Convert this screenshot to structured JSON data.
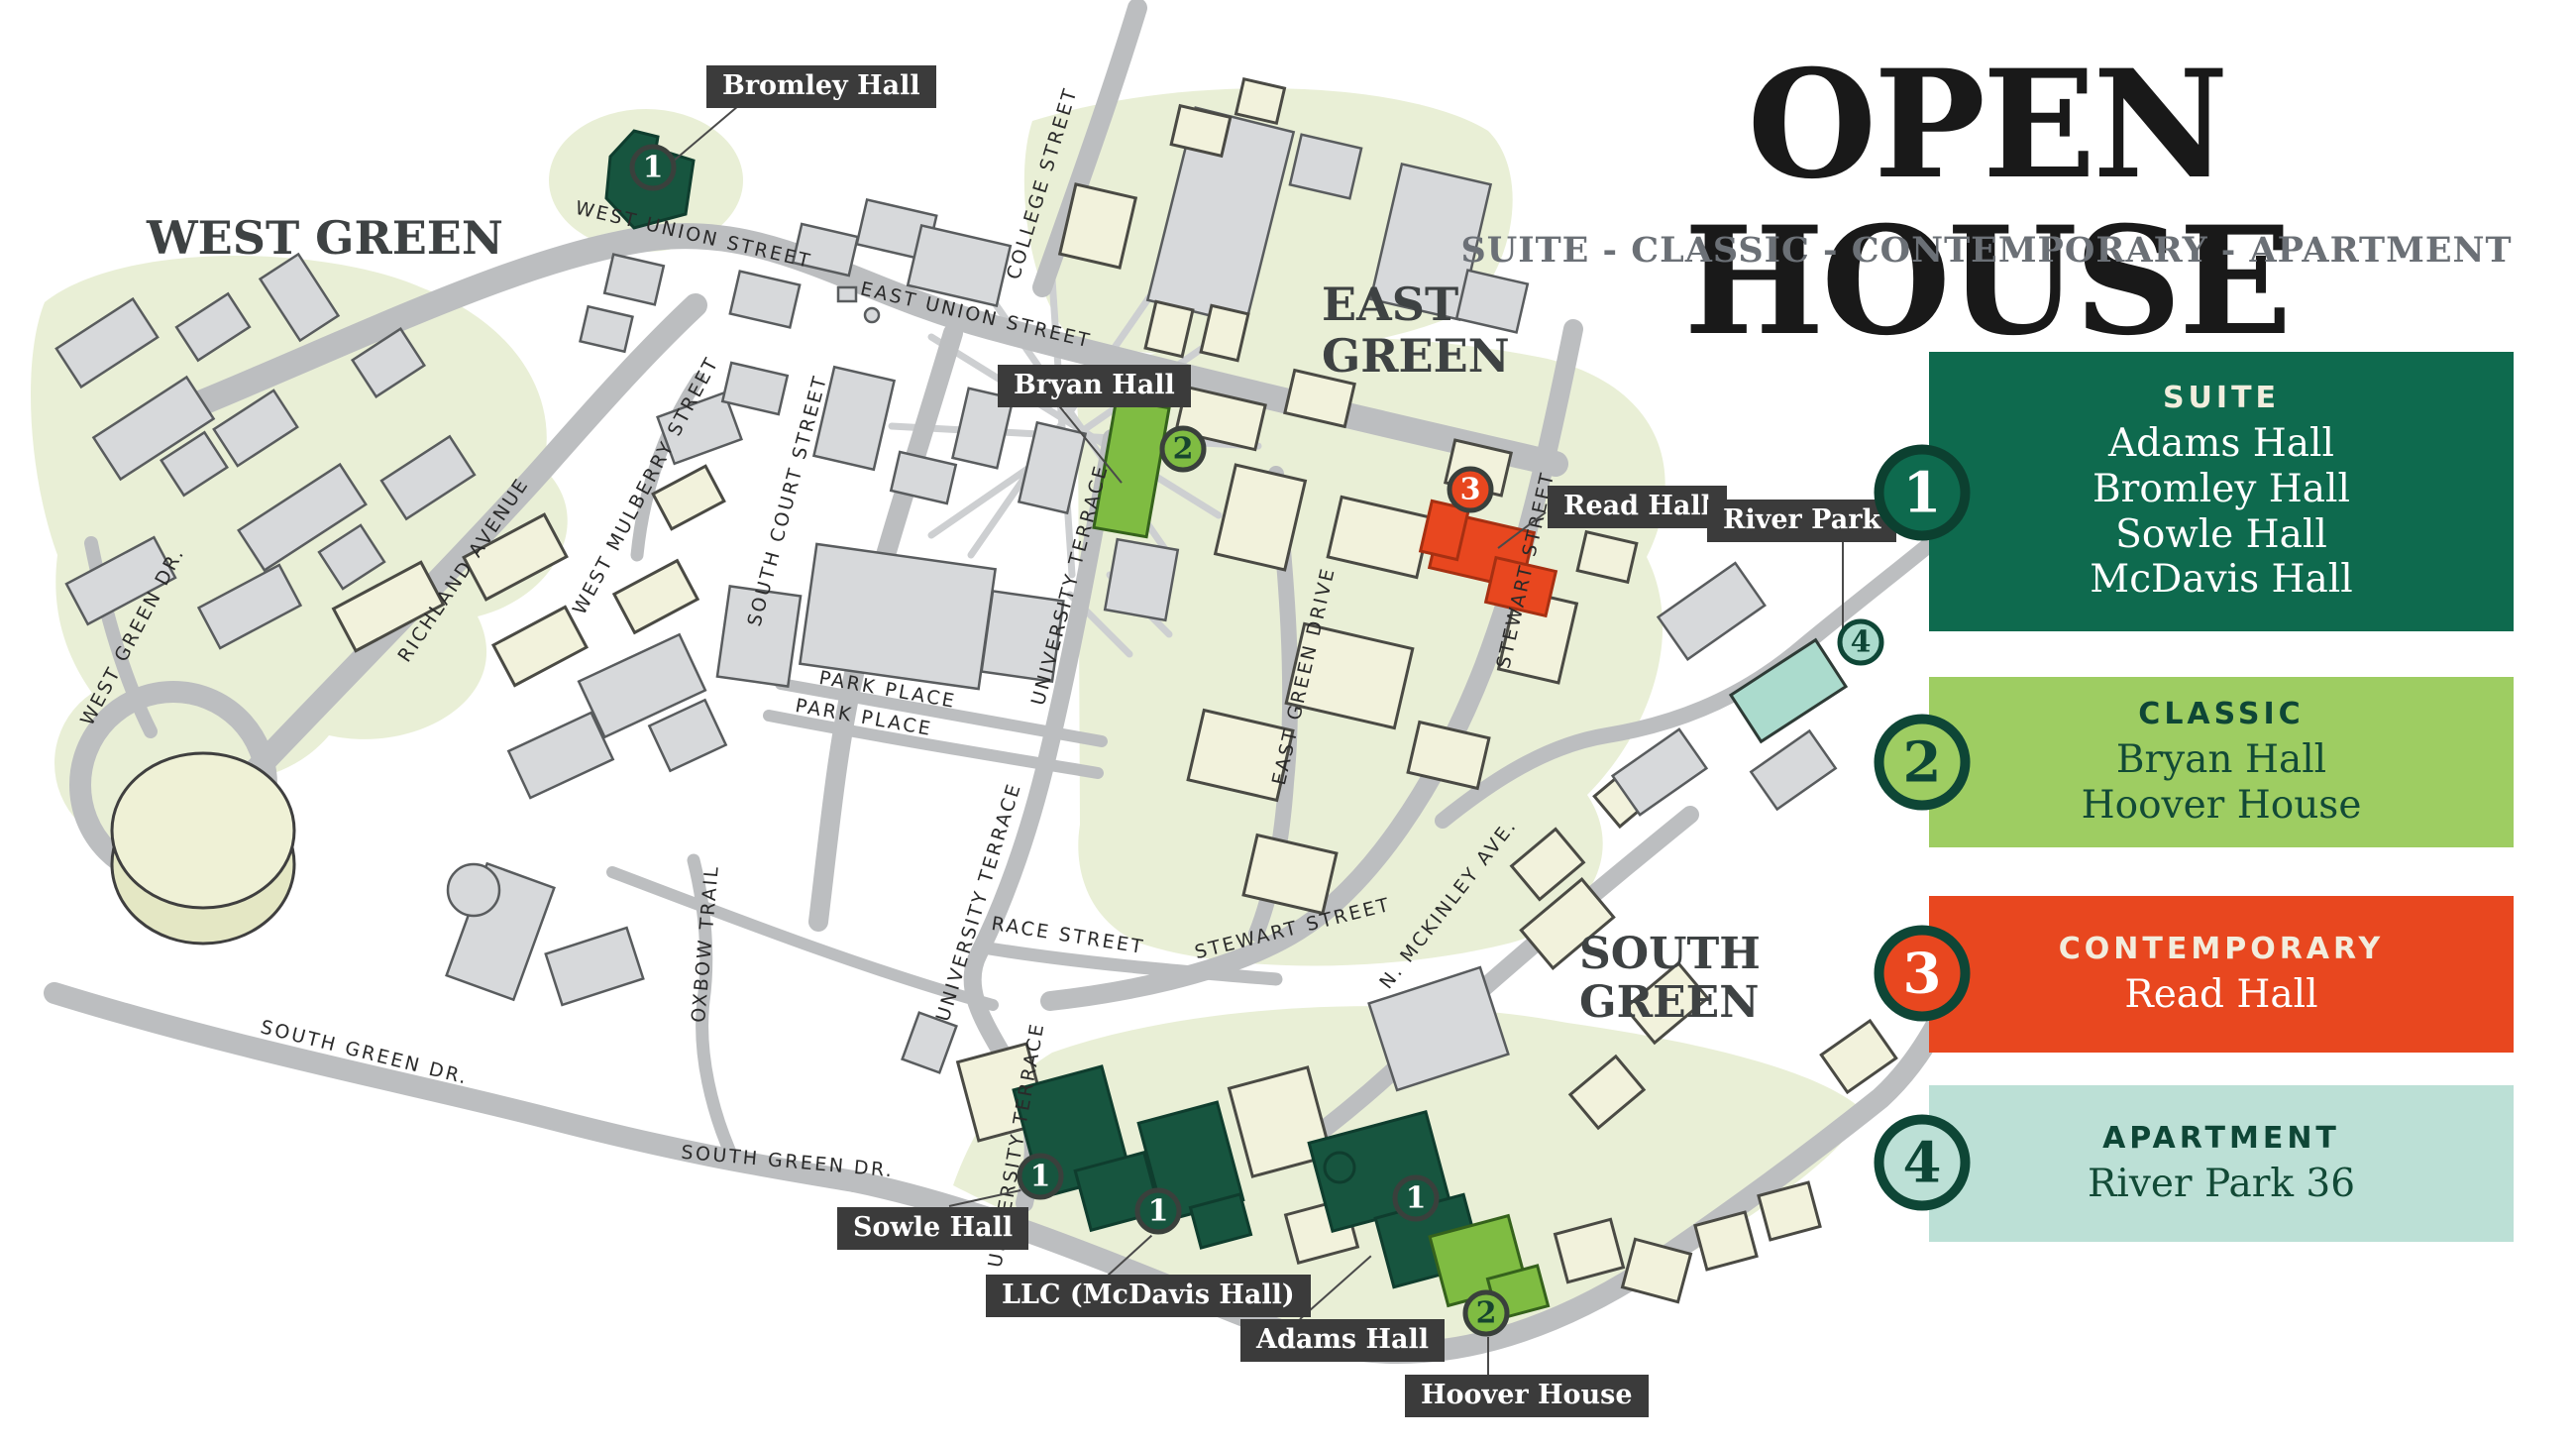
{
  "header": {
    "title": "OPEN HOUSE",
    "subtitle": "SUITE - CLASSIC - CONTEMPORARY - APARTMENT"
  },
  "regions": [
    "WEST GREEN",
    "EAST GREEN",
    "SOUTH GREEN"
  ],
  "legend": [
    {
      "number": "1",
      "category": "SUITE",
      "items": [
        "Adams Hall",
        "Bromley Hall",
        "Sowle Hall",
        "McDavis Hall"
      ],
      "color": "#0E6A4E"
    },
    {
      "number": "2",
      "category": "CLASSIC",
      "items": [
        "Bryan Hall",
        "Hoover House"
      ],
      "color": "#9ECD62"
    },
    {
      "number": "3",
      "category": "CONTEMPORARY",
      "items": [
        "Read Hall"
      ],
      "color": "#E8471F"
    },
    {
      "number": "4",
      "category": "APARTMENT",
      "items": [
        "River Park 36"
      ],
      "color": "#BCE0D6"
    }
  ],
  "building_labels": [
    "Bromley Hall",
    "Bryan Hall",
    "Read Hall",
    "River Park",
    "Sowle Hall",
    "LLC (McDavis Hall)",
    "Adams Hall",
    "Hoover House"
  ],
  "map_markers": [
    {
      "number": "1",
      "category": "suite",
      "place": "Bromley Hall"
    },
    {
      "number": "2",
      "category": "classic",
      "place": "Bryan Hall"
    },
    {
      "number": "3",
      "category": "contemporary",
      "place": "Read Hall"
    },
    {
      "number": "4",
      "category": "apartment",
      "place": "River Park 36"
    },
    {
      "number": "1",
      "category": "suite",
      "place": "Sowle Hall"
    },
    {
      "number": "1",
      "category": "suite",
      "place": "McDavis Hall"
    },
    {
      "number": "1",
      "category": "suite",
      "place": "Adams Hall"
    },
    {
      "number": "2",
      "category": "classic",
      "place": "Hoover House"
    }
  ],
  "streets": [
    "WEST UNION STREET",
    "EAST UNION STREET",
    "COLLEGE STREET",
    "RICHLAND AVENUE",
    "WEST MULBERRY STREET",
    "SOUTH COURT STREET",
    "UNIVERSITY TERRACE",
    "PARK PLACE",
    "PARK PLACE",
    "UNIVERSITY TERRACE",
    "RACE STREET",
    "STEWART STREET",
    "STEWART STREET",
    "EAST GREEN DRIVE",
    "N. MCKINLEY AVE.",
    "SOUTH GREEN DR.",
    "SOUTH GREEN DR.",
    "OXBOW TRAIL",
    "WEST GREEN DR.",
    "UNIVERSITY TERRACE"
  ],
  "colors": {
    "suite": "#0E6A4E",
    "suite_building": "#17553F",
    "classic": "#9ECD62",
    "classic_building": "#7FBC42",
    "contemporary": "#E8471F",
    "apartment": "#BCE0D6",
    "apartment_building": "#ABDBCD",
    "label_chip": "#3B3B3B",
    "road": "#BCBEC0",
    "green_area": "#E9EFD6",
    "legend_ring": "#0C4030",
    "map_ring": "#3A403C"
  }
}
